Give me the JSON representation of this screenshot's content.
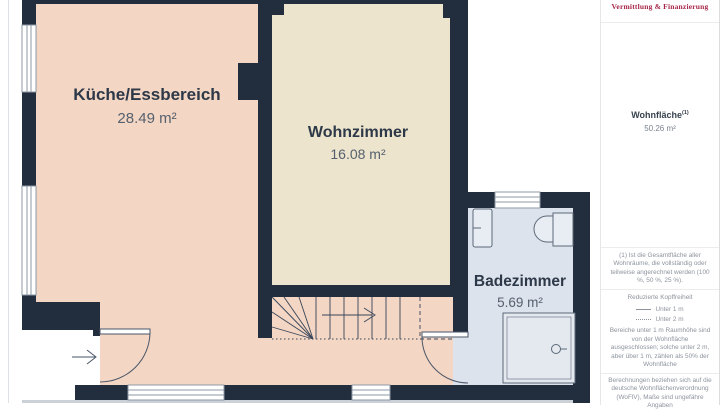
{
  "plan": {
    "rooms": [
      {
        "name": "Küche/Essbereich",
        "area": "28.49 m²"
      },
      {
        "name": "Wohnzimmer",
        "area": "16.08 m²"
      },
      {
        "name": "Badezimmer",
        "area": "5.69 m²"
      }
    ],
    "colors": {
      "wall": "#222d3d",
      "kitchen_floor": "#f3d6c3",
      "living_floor": "#ece4cc",
      "bath_floor": "#dde3ec",
      "fixture_stroke": "#5c6878",
      "label": "#2d3848",
      "area_text": "#55606e"
    }
  },
  "sidebar": {
    "brand": "Vermittlung & Finanzierung",
    "brand_color": "#a72648",
    "total_label": "Wohnfläche",
    "total_sup": "(1)",
    "total_value": "50.26 m²",
    "footnote": "(1) Ist die Gesamtfläche aller Wohnräume, die vollständig oder teilweise angerechnet werden (100 %, 50 %, 25 %).",
    "headroom": {
      "title": "Reduzierte Kopffreiheit",
      "legend": [
        {
          "style": "solid",
          "label": "Unter 1 m"
        },
        {
          "style": "dotted",
          "label": "Unter 2 m"
        }
      ],
      "note": "Bereiche unter 1 m Raumhöhe sind von der Wohnfläche ausgeschlossen; solche unter 2 m, aber über 1 m, zählen als 50% der Wohnfläche"
    },
    "disclaimer": "Berechnungen beziehen sich auf die deutsche Wohnflächenverordnung (WoFlV), Maße sind ungefähre Angaben"
  }
}
